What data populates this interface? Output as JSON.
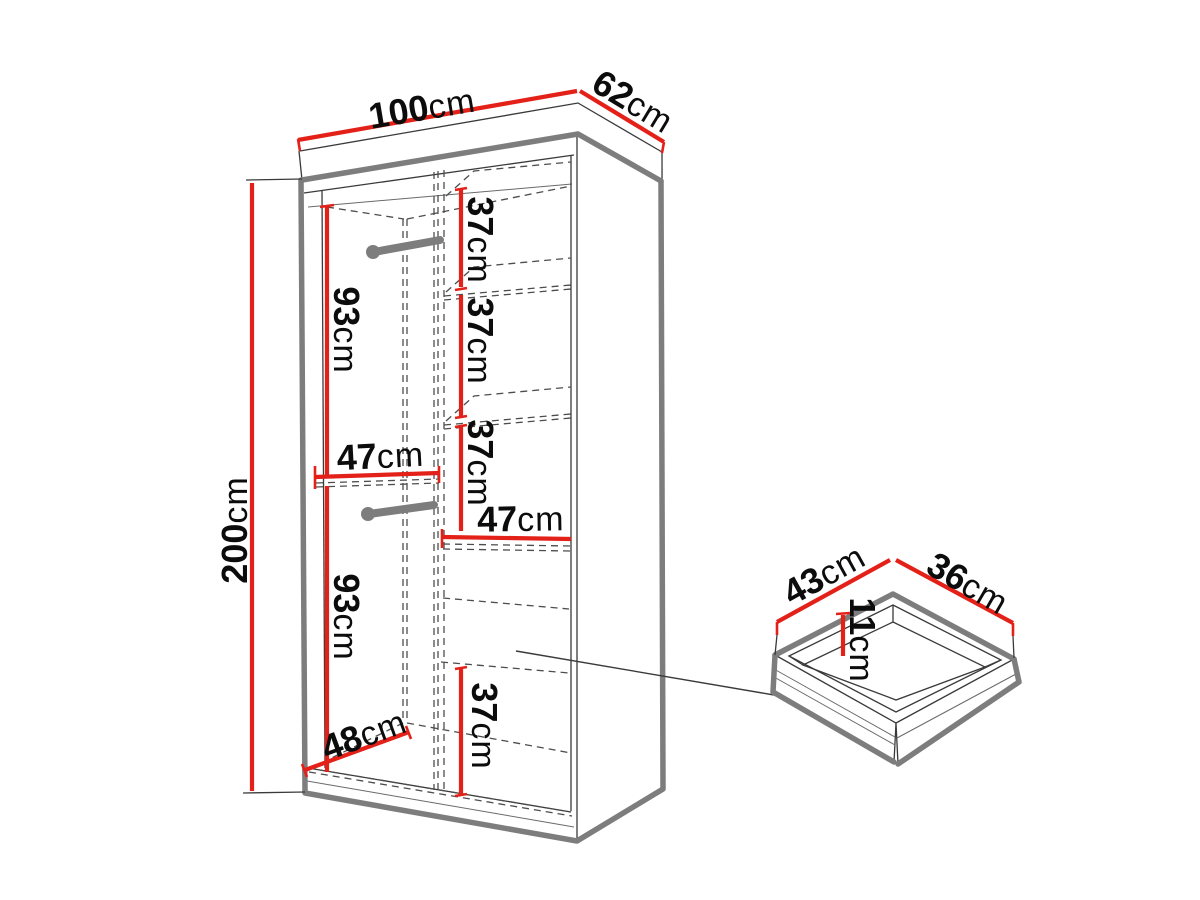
{
  "wardrobe": {
    "width": {
      "value": "100",
      "unit": "cm"
    },
    "depth": {
      "value": "62",
      "unit": "cm"
    },
    "height": {
      "value": "200",
      "unit": "cm"
    },
    "left_section": {
      "upper_hanging_height": {
        "value": "93",
        "unit": "cm"
      },
      "width": {
        "value": "47",
        "unit": "cm"
      },
      "lower_hanging_height": {
        "value": "93",
        "unit": "cm"
      },
      "floor_depth": {
        "value": "48",
        "unit": "cm"
      }
    },
    "right_section": {
      "shelf_spacings": [
        {
          "value": "37",
          "unit": "cm"
        },
        {
          "value": "37",
          "unit": "cm"
        },
        {
          "value": "37",
          "unit": "cm"
        }
      ],
      "width": {
        "value": "47",
        "unit": "cm"
      },
      "bottom_compartment_height": {
        "value": "37",
        "unit": "cm"
      }
    }
  },
  "drawer": {
    "width": {
      "value": "43",
      "unit": "cm"
    },
    "depth": {
      "value": "36",
      "unit": "cm"
    },
    "inner_height": {
      "value": "11",
      "unit": "cm"
    }
  },
  "colors": {
    "dimension_red": "#e32119",
    "structure_gray": "#7d7d7d",
    "line_black": "#3a3a3a",
    "background": "#ffffff"
  }
}
